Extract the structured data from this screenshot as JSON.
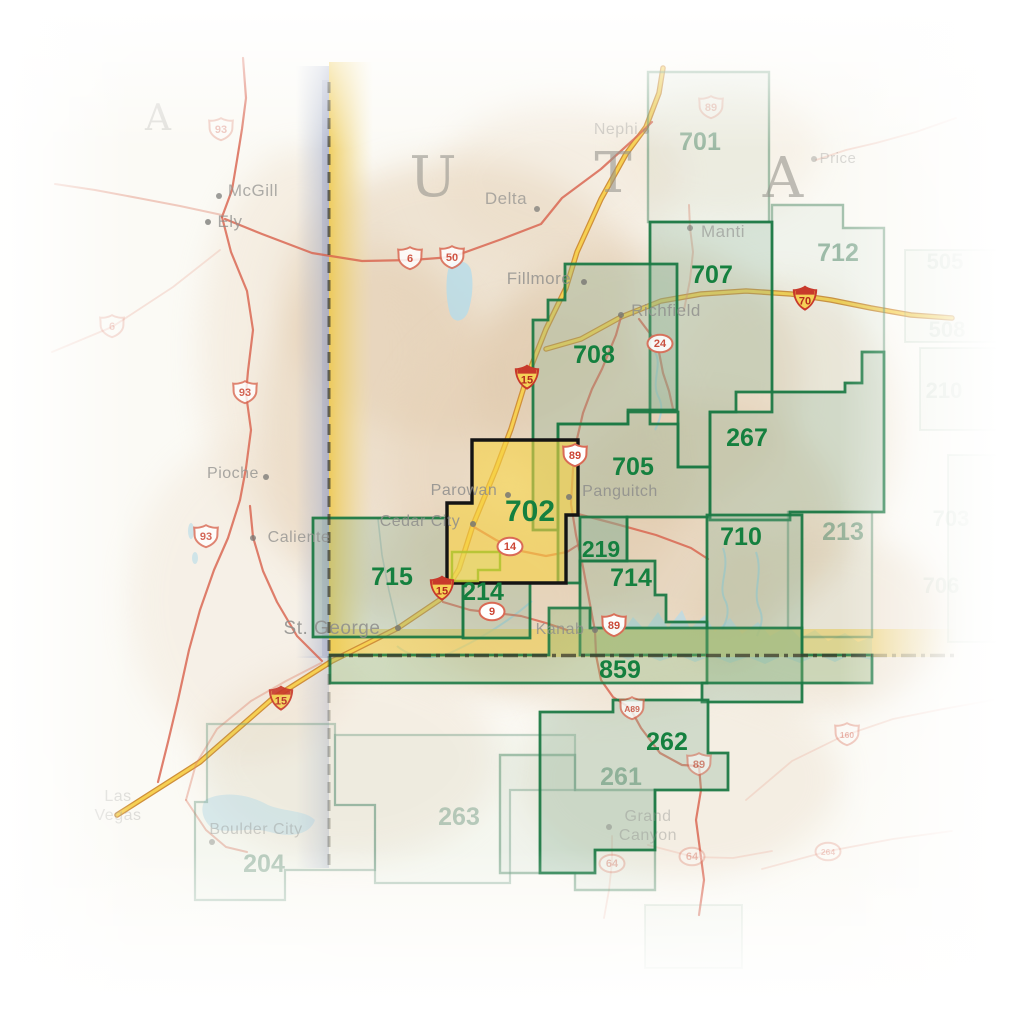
{
  "map": {
    "title": "Trails Illustrated index map, southwest Utah (map 702 highlighted)",
    "state_letters": [
      {
        "char": "U",
        "x": 433,
        "y": 196
      },
      {
        "char": "T",
        "x": 613,
        "y": 192
      },
      {
        "char": "A",
        "x": 783,
        "y": 197
      }
    ],
    "neighbor_letter": {
      "char": "A",
      "x": 158,
      "y": 130
    },
    "colors": {
      "area_green": "#15803f",
      "area_faded": "#5a8f72",
      "area_faint": "#7aa18c",
      "highlight_yellow": "#f2cd49",
      "interstate_yellow": "#f6d052",
      "road_red": "#d8604b",
      "water_blue": "#b5dcea",
      "city_gray": "#8e8e8c",
      "border_black": "#3a3a2c"
    },
    "areas": [
      {
        "id": "701",
        "label": "701",
        "lx": 700,
        "ly": 150,
        "cls": "faded",
        "pts": "648,72 769,72 769,222 648,222"
      },
      {
        "id": "712",
        "label": "712",
        "lx": 838,
        "ly": 261,
        "cls": "faded",
        "pts": "772,205 843,205 843,228 884,228 884,352 862,352 862,383 845,383 845,392 772,392"
      },
      {
        "id": "213",
        "label": "213",
        "lx": 843,
        "ly": 540,
        "cls": "faded",
        "pts": "788,512 872,512 872,637 802,637 802,628 788,628"
      },
      {
        "id": "261",
        "label": "261",
        "lx": 621,
        "ly": 785,
        "cls": "faded",
        "pts": "500,755 575,755 575,790 655,790 655,890 575,890 575,873 500,873"
      },
      {
        "id": "263",
        "label": "263",
        "lx": 459,
        "ly": 825,
        "cls": "faded2",
        "pts": "335,735 575,735 575,790 510,790 510,883 375,883 375,805 335,805"
      },
      {
        "id": "204",
        "label": "204",
        "lx": 264,
        "ly": 872,
        "cls": "faded2",
        "pts": "207,724 335,724 335,805 375,805 375,870 285,870 285,900 195,900 195,802 207,802"
      },
      {
        "id": "707",
        "label": "707",
        "lx": 712,
        "ly": 283,
        "cls": "strong",
        "pts": "650,222 772,222 772,392 736,392 736,412 710,412 710,467 678,467 678,412 650,412"
      },
      {
        "id": "708",
        "label": "708",
        "lx": 594,
        "ly": 363,
        "cls": "strong",
        "pts": "565,264 677,264 677,410 628,410 628,424 558,424 558,530 533,530 533,320 548,320 548,300 565,300"
      },
      {
        "id": "705",
        "label": "705",
        "lx": 633,
        "ly": 475,
        "cls": "strong",
        "pts": "558,424 628,424 628,412 650,412 650,424 678,424 678,467 710,467 710,517 627,517 627,561 580,561 580,583 558,583"
      },
      {
        "id": "267",
        "label": "267",
        "lx": 747,
        "ly": 446,
        "cls": "strong",
        "pts": "710,412 772,412 772,392 845,392 845,383 862,383 862,352 884,352 884,512 790,512 790,520 710,520"
      },
      {
        "id": "710",
        "label": "710",
        "lx": 741,
        "ly": 545,
        "cls": "strong",
        "pts": "707,515 802,515 802,702 702,702 702,683 707,683"
      },
      {
        "id": "219",
        "label": "219",
        "lx": 601,
        "ly": 557,
        "cls": "strong",
        "pts": "580,517 627,517 627,561 580,561"
      },
      {
        "id": "714",
        "label": "714",
        "lx": 631,
        "ly": 586,
        "cls": "strong",
        "pts": "580,561 655,561 655,595 666,595 666,622 707,622 707,655 580,655"
      },
      {
        "id": "715",
        "label": "715",
        "lx": 392,
        "ly": 585,
        "cls": "strong",
        "pts": "313,518 447,518 447,583 463,583 463,637 313,637"
      },
      {
        "id": "214",
        "label": "214",
        "lx": 483,
        "ly": 600,
        "cls": "strong",
        "pts": "463,583 530,583 530,638 463,638"
      },
      {
        "id": "859",
        "label": "859",
        "lx": 620,
        "ly": 678,
        "cls": "band",
        "pts": "549,608 590,608 590,628 802,628 802,655 872,655 872,683 330,683 330,655 549,655"
      },
      {
        "id": "262",
        "label": "262",
        "lx": 667,
        "ly": 750,
        "cls": "strong",
        "pts": "540,712 613,712 613,700 708,700 708,753 728,753 728,790 655,790 655,850 595,850 595,873 540,873"
      },
      {
        "id": "702",
        "label": "702",
        "lx": 530,
        "ly": 521,
        "cls": "highlight",
        "pts": "472,440 578,440 578,515 566,515 566,583 447,583 447,503 472,503"
      },
      {
        "id": "cedar-breaks",
        "label": "",
        "lx": 0,
        "ly": 0,
        "cls": "cedar",
        "pts": "452,552 500,552 500,570 478,570 478,581 452,581"
      }
    ],
    "faint_rects": [
      {
        "pts": "905,250 1005,250 1005,342 905,342"
      },
      {
        "pts": "920,348 1012,348 1012,430 920,430"
      },
      {
        "pts": "948,455 1023,455 1023,642 948,642"
      },
      {
        "pts": "645,905 742,905 742,968 645,968"
      }
    ],
    "edge_labels": [
      {
        "t": "505",
        "x": 945,
        "y": 269
      },
      {
        "t": "508",
        "x": 947,
        "y": 337
      },
      {
        "t": "210",
        "x": 944,
        "y": 398
      },
      {
        "t": "703",
        "x": 951,
        "y": 526
      },
      {
        "t": "706",
        "x": 941,
        "y": 593
      }
    ],
    "cities": [
      {
        "name": "McGill",
        "x": 253,
        "y": 196,
        "dx": 219,
        "dy": 196,
        "op": 0.7,
        "size": 17
      },
      {
        "name": "Ely",
        "x": 230,
        "y": 227,
        "dx": 208,
        "dy": 222,
        "op": 0.75,
        "size": 17
      },
      {
        "name": "Pioche",
        "x": 233,
        "y": 478,
        "dx": 266,
        "dy": 477,
        "op": 0.75,
        "size": 16
      },
      {
        "name": "Caliente",
        "x": 299,
        "y": 542,
        "dx": 253,
        "dy": 538,
        "op": 0.75,
        "size": 16
      },
      {
        "name": "Delta",
        "x": 506,
        "y": 204,
        "dx": 537,
        "dy": 209,
        "op": 0.7,
        "size": 17
      },
      {
        "name": "Nephi",
        "x": 616,
        "y": 134,
        "dx": 646,
        "dy": 131,
        "op": 0.4,
        "size": 16
      },
      {
        "name": "Manti",
        "x": 723,
        "y": 237,
        "dx": 690,
        "dy": 228,
        "op": 0.6,
        "size": 17
      },
      {
        "name": "Price",
        "x": 838,
        "y": 163,
        "dx": 814,
        "dy": 159,
        "op": 0.32,
        "size": 15
      },
      {
        "name": "Fillmore",
        "x": 539,
        "y": 284,
        "dx": 584,
        "dy": 282,
        "op": 0.8,
        "size": 17
      },
      {
        "name": "Richfield",
        "x": 666,
        "y": 316,
        "dx": 621,
        "dy": 315,
        "op": 0.8,
        "size": 17
      },
      {
        "name": "Parowan",
        "x": 464,
        "y": 495,
        "dx": 508,
        "dy": 495,
        "op": 0.85,
        "size": 16
      },
      {
        "name": "Panguitch",
        "x": 620,
        "y": 496,
        "dx": 569,
        "dy": 497,
        "op": 0.85,
        "size": 16
      },
      {
        "name": "Cedar City",
        "x": 420,
        "y": 526,
        "dx": 473,
        "dy": 524,
        "op": 0.85,
        "size": 16
      },
      {
        "name": "St. George",
        "x": 332,
        "y": 634,
        "dx": 398,
        "dy": 628,
        "op": 0.85,
        "size": 19
      },
      {
        "name": "Kanab",
        "x": 560,
        "y": 634,
        "dx": 595,
        "dy": 630,
        "op": 0.8,
        "size": 16
      },
      {
        "name": "Boulder City",
        "x": 256,
        "y": 834,
        "dx": 212,
        "dy": 842,
        "op": 0.38,
        "size": 16
      },
      {
        "name": "Grand\nCanyon",
        "x": 648,
        "y": 821,
        "dx": 609,
        "dy": 827,
        "op": 0.4,
        "size": 16
      },
      {
        "name": "Las\nVegas",
        "x": 118,
        "y": 801,
        "dx": 0,
        "dy": 0,
        "op": 0.28,
        "size": 16
      }
    ],
    "shields": [
      {
        "type": "us",
        "label": "93",
        "x": 245,
        "y": 393,
        "op": 0.8
      },
      {
        "type": "us",
        "label": "93",
        "x": 206,
        "y": 537,
        "op": 0.8
      },
      {
        "type": "us",
        "label": "93",
        "x": 221,
        "y": 130,
        "op": 0.3
      },
      {
        "type": "us",
        "label": "6",
        "x": 410,
        "y": 259,
        "op": 0.85
      },
      {
        "type": "us",
        "label": "50",
        "x": 452,
        "y": 258,
        "op": 0.85
      },
      {
        "type": "us",
        "label": "6",
        "x": 112,
        "y": 327,
        "op": 0.22
      },
      {
        "type": "us",
        "label": "89",
        "x": 711,
        "y": 108,
        "op": 0.25
      },
      {
        "type": "i",
        "label": "15",
        "x": 527,
        "y": 377,
        "op": 1
      },
      {
        "type": "i",
        "label": "15",
        "x": 442,
        "y": 588,
        "op": 1
      },
      {
        "type": "i",
        "label": "15",
        "x": 281,
        "y": 698,
        "op": 0.9
      },
      {
        "type": "i",
        "label": "70",
        "x": 805,
        "y": 298,
        "op": 1
      },
      {
        "type": "oval",
        "label": "24",
        "x": 660,
        "y": 344,
        "op": 0.9
      },
      {
        "type": "us",
        "label": "89",
        "x": 575,
        "y": 456,
        "op": 1
      },
      {
        "type": "oval",
        "label": "14",
        "x": 510,
        "y": 547,
        "op": 1
      },
      {
        "type": "oval",
        "label": "9",
        "x": 492,
        "y": 612,
        "op": 1
      },
      {
        "type": "us",
        "label": "89",
        "x": 614,
        "y": 626,
        "op": 0.95
      },
      {
        "type": "us",
        "label": "89",
        "x": 699,
        "y": 765,
        "op": 0.55
      },
      {
        "type": "us",
        "label": "A89",
        "x": 632,
        "y": 709,
        "op": 0.75
      },
      {
        "type": "us",
        "label": "160",
        "x": 847,
        "y": 735,
        "op": 0.35
      },
      {
        "type": "oval",
        "label": "64",
        "x": 612,
        "y": 864,
        "op": 0.3
      },
      {
        "type": "oval",
        "label": "64",
        "x": 692,
        "y": 857,
        "op": 0.3
      },
      {
        "type": "oval",
        "label": "264",
        "x": 828,
        "y": 852,
        "op": 0.25
      }
    ],
    "roads": [
      {
        "name": "I-15",
        "type": "i",
        "d": "M117,815 L200,762 L272,699 L332,661 L398,628 L441,599 L459,569 L473,525 L496,469 L511,429 L527,377 L546,329 L566,288 L577,252 L601,199 L626,154 L646,127 L659,93 L663,68"
      },
      {
        "name": "I-70",
        "type": "i",
        "d": "M546,349 L581,339 L621,317 L661,301 L701,294 L746,291 L791,294 L831,300 L871,308 L911,315 L952,318"
      },
      {
        "name": "US-6/50",
        "type": "r",
        "d": "M225,219 L262,234 L312,253 L362,261 L412,260 L452,257 L502,239 L541,224 L562,198 L601,169 L633,140 L652,122"
      },
      {
        "name": "US-93 north",
        "type": "r",
        "d": "M243,58 L246,98 L242,129 L237,160 L232,190 L222,217"
      },
      {
        "name": "US-93 south",
        "type": "r",
        "d": "M222,217 L231,252 L247,291 L253,330 L248,371 L246,394 L251,430 L246,468 L240,500 L228,538 L214,570 L200,610 L189,650 L178,700 L168,742 L158,782"
      },
      {
        "name": "Ely west",
        "type": "rf",
        "d": "M222,215 L180,206 L138,198 L95,190 L55,184"
      },
      {
        "name": "US-6 southwest",
        "type": "rf2",
        "d": "M52,352 L112,327 L173,287 L220,250"
      },
      {
        "name": "Caliente road",
        "type": "r",
        "d": "M250,506 L253,537 L263,571 L277,602 L297,636 L322,661"
      },
      {
        "name": "US-89 north",
        "type": "r",
        "d": "M596,654 L595,631 L589,599 L583,567 L576,535 L571,504 L573,469 L577,439 L583,413 L592,389 L602,369 L616,335 L621,317"
      },
      {
        "name": "US-89 south",
        "type": "r",
        "d": "M596,655 L601,680 L613,697 L630,708 L641,728 L660,753 L682,765 L699,766 L701,790 L696,820 L700,850 L704,880 L699,915"
      },
      {
        "name": "SR-14",
        "type": "r",
        "d": "M474,527 L496,540 L521,551 L546,556 L567,552 L578,545"
      },
      {
        "name": "SR-9",
        "type": "r",
        "d": "M443,602 L470,610 L496,613 L521,616 L546,623 L567,630"
      },
      {
        "name": "SR-24",
        "type": "r",
        "d": "M639,319 L651,335 L659,352 L663,373 L669,391 L673,409"
      },
      {
        "name": "SR-12",
        "type": "r",
        "d": "M578,514 L616,524 L656,535 L691,548 L708,559"
      },
      {
        "name": "Sanpete road",
        "type": "rf",
        "d": "M689,205 L690,228 L693,252 L690,280 L684,310"
      },
      {
        "name": "Price road",
        "type": "rf2",
        "d": "M816,160 L846,150 L876,143 L916,132 L956,118"
      },
      {
        "name": "US-160",
        "type": "rf2",
        "d": "M746,800 L792,761 L843,736 L893,719 L943,709 L993,700"
      },
      {
        "name": "US-264",
        "type": "rf2",
        "d": "M762,869 L829,851 L893,839 L952,831"
      },
      {
        "name": "SR-64 south",
        "type": "rf2",
        "d": "M612,836 L612,862 L609,890 L604,918"
      },
      {
        "name": "SR-64 east",
        "type": "rf2",
        "d": "M648,845 L694,857 L733,858 L772,851"
      },
      {
        "name": "St George north road",
        "type": "m",
        "d": "M397,625 L389,591 L382,555 L378,519"
      },
      {
        "name": "NV corner road a",
        "type": "rf",
        "d": "M321,663 L286,681 L251,701 L217,729 L196,764 L186,800"
      },
      {
        "name": "NV corner road b",
        "type": "rf",
        "d": "M186,800 L206,830 L226,847 L247,852"
      }
    ],
    "water": {
      "shapes": [
        {
          "name": "sevier-lake",
          "d": "M449,266 C455,258 468,260 471,270 C474,284 472,300 468,312 C464,322 454,324 450,314 C446,300 445,280 449,266 Z",
          "op": 0.8
        },
        {
          "name": "lake-powell",
          "d": "M593,640 L610,622 L622,633 L633,617 L645,630 L658,612 L668,628 L682,610 L690,629 L705,615 L715,632 L730,618 L742,634 L758,622 L770,636 L788,626 L800,638 L815,630 L828,641 L845,633 L858,642 L872,637 L872,660 L850,655 L835,662 L818,655 L800,663 L782,656 L765,664 L748,657 L730,663 L712,656 L695,662 L678,655 L660,661 L643,654 L628,660 L612,652 L598,656 Z",
          "op": 0.7
        },
        {
          "name": "lake-mead",
          "d": "M205,800 C225,790 250,795 268,805 C285,812 305,810 315,820 C310,835 290,838 270,832 C250,826 228,835 212,828 C202,820 200,808 205,800 Z",
          "op": 0.45
        }
      ],
      "rivers": [
        {
          "d": "M655,352 C663,366 650,382 659,398 C664,408 660,420 655,430"
        },
        {
          "d": "M723,548 C731,570 716,586 726,602 C730,612 726,622 722,630"
        },
        {
          "d": "M756,552 C764,575 751,592 760,610 C764,620 760,628 757,636"
        },
        {
          "d": "M532,601 C508,622 478,640 450,653 C430,661 410,657 397,646"
        }
      ],
      "ponds": [
        {
          "cx": 191,
          "cy": 531,
          "rx": 3,
          "ry": 8
        },
        {
          "cx": 195,
          "cy": 558,
          "rx": 3,
          "ry": 6
        }
      ]
    },
    "border": {
      "vertical_dash": {
        "x": 329,
        "y1": 82,
        "y2": 656
      },
      "vertical_dash_faded": {
        "x": 329,
        "y1": 656,
        "y2": 866
      },
      "horizontal_dash": {
        "y": 655.5,
        "x1": 329,
        "x2": 872
      },
      "horizontal_dash_faded": {
        "y": 655.5,
        "x1": 872,
        "x2": 958
      }
    }
  }
}
